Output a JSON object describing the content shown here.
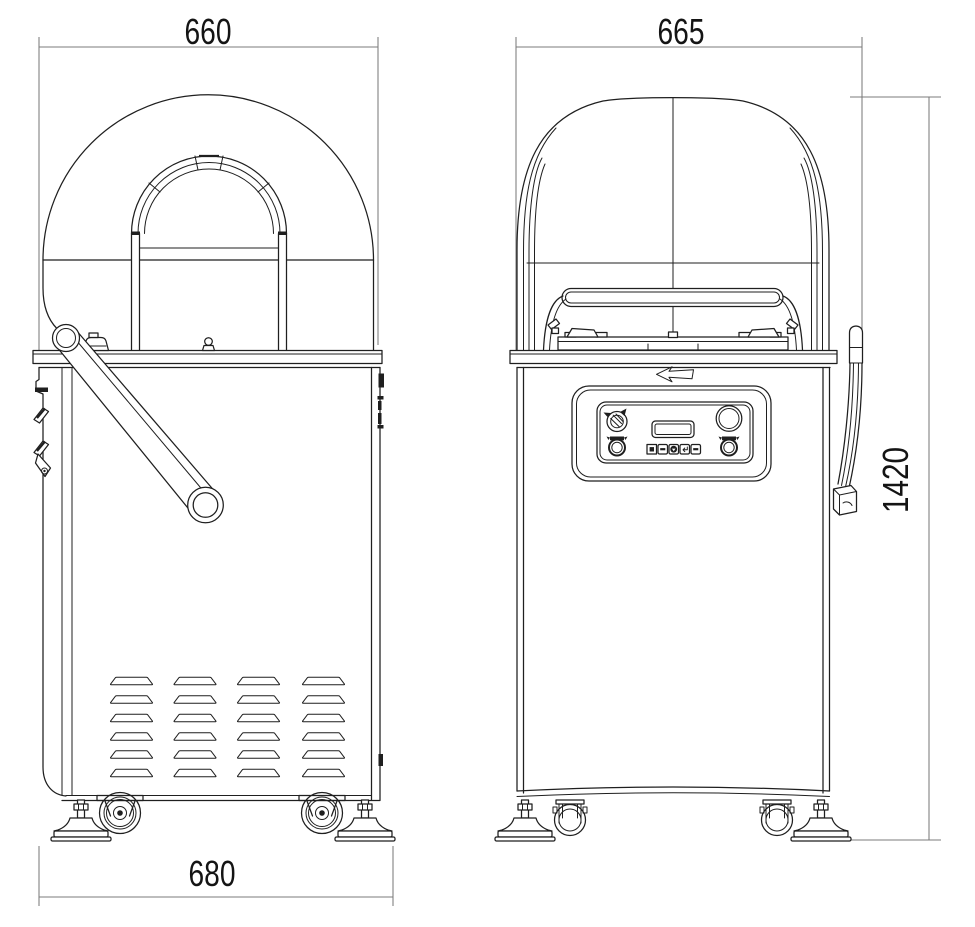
{
  "drawing": {
    "type": "technical-dimension-drawing",
    "views": {
      "side_view": {
        "top_width_label": "660",
        "bottom_width_label": "680"
      },
      "front_view": {
        "top_width_label": "665",
        "height_label": "1420"
      }
    },
    "colors": {
      "background": "#ffffff",
      "drawing_line": "#1f1f1f",
      "dimension_line": "#7b7b7b",
      "label_text": "#141414"
    }
  }
}
